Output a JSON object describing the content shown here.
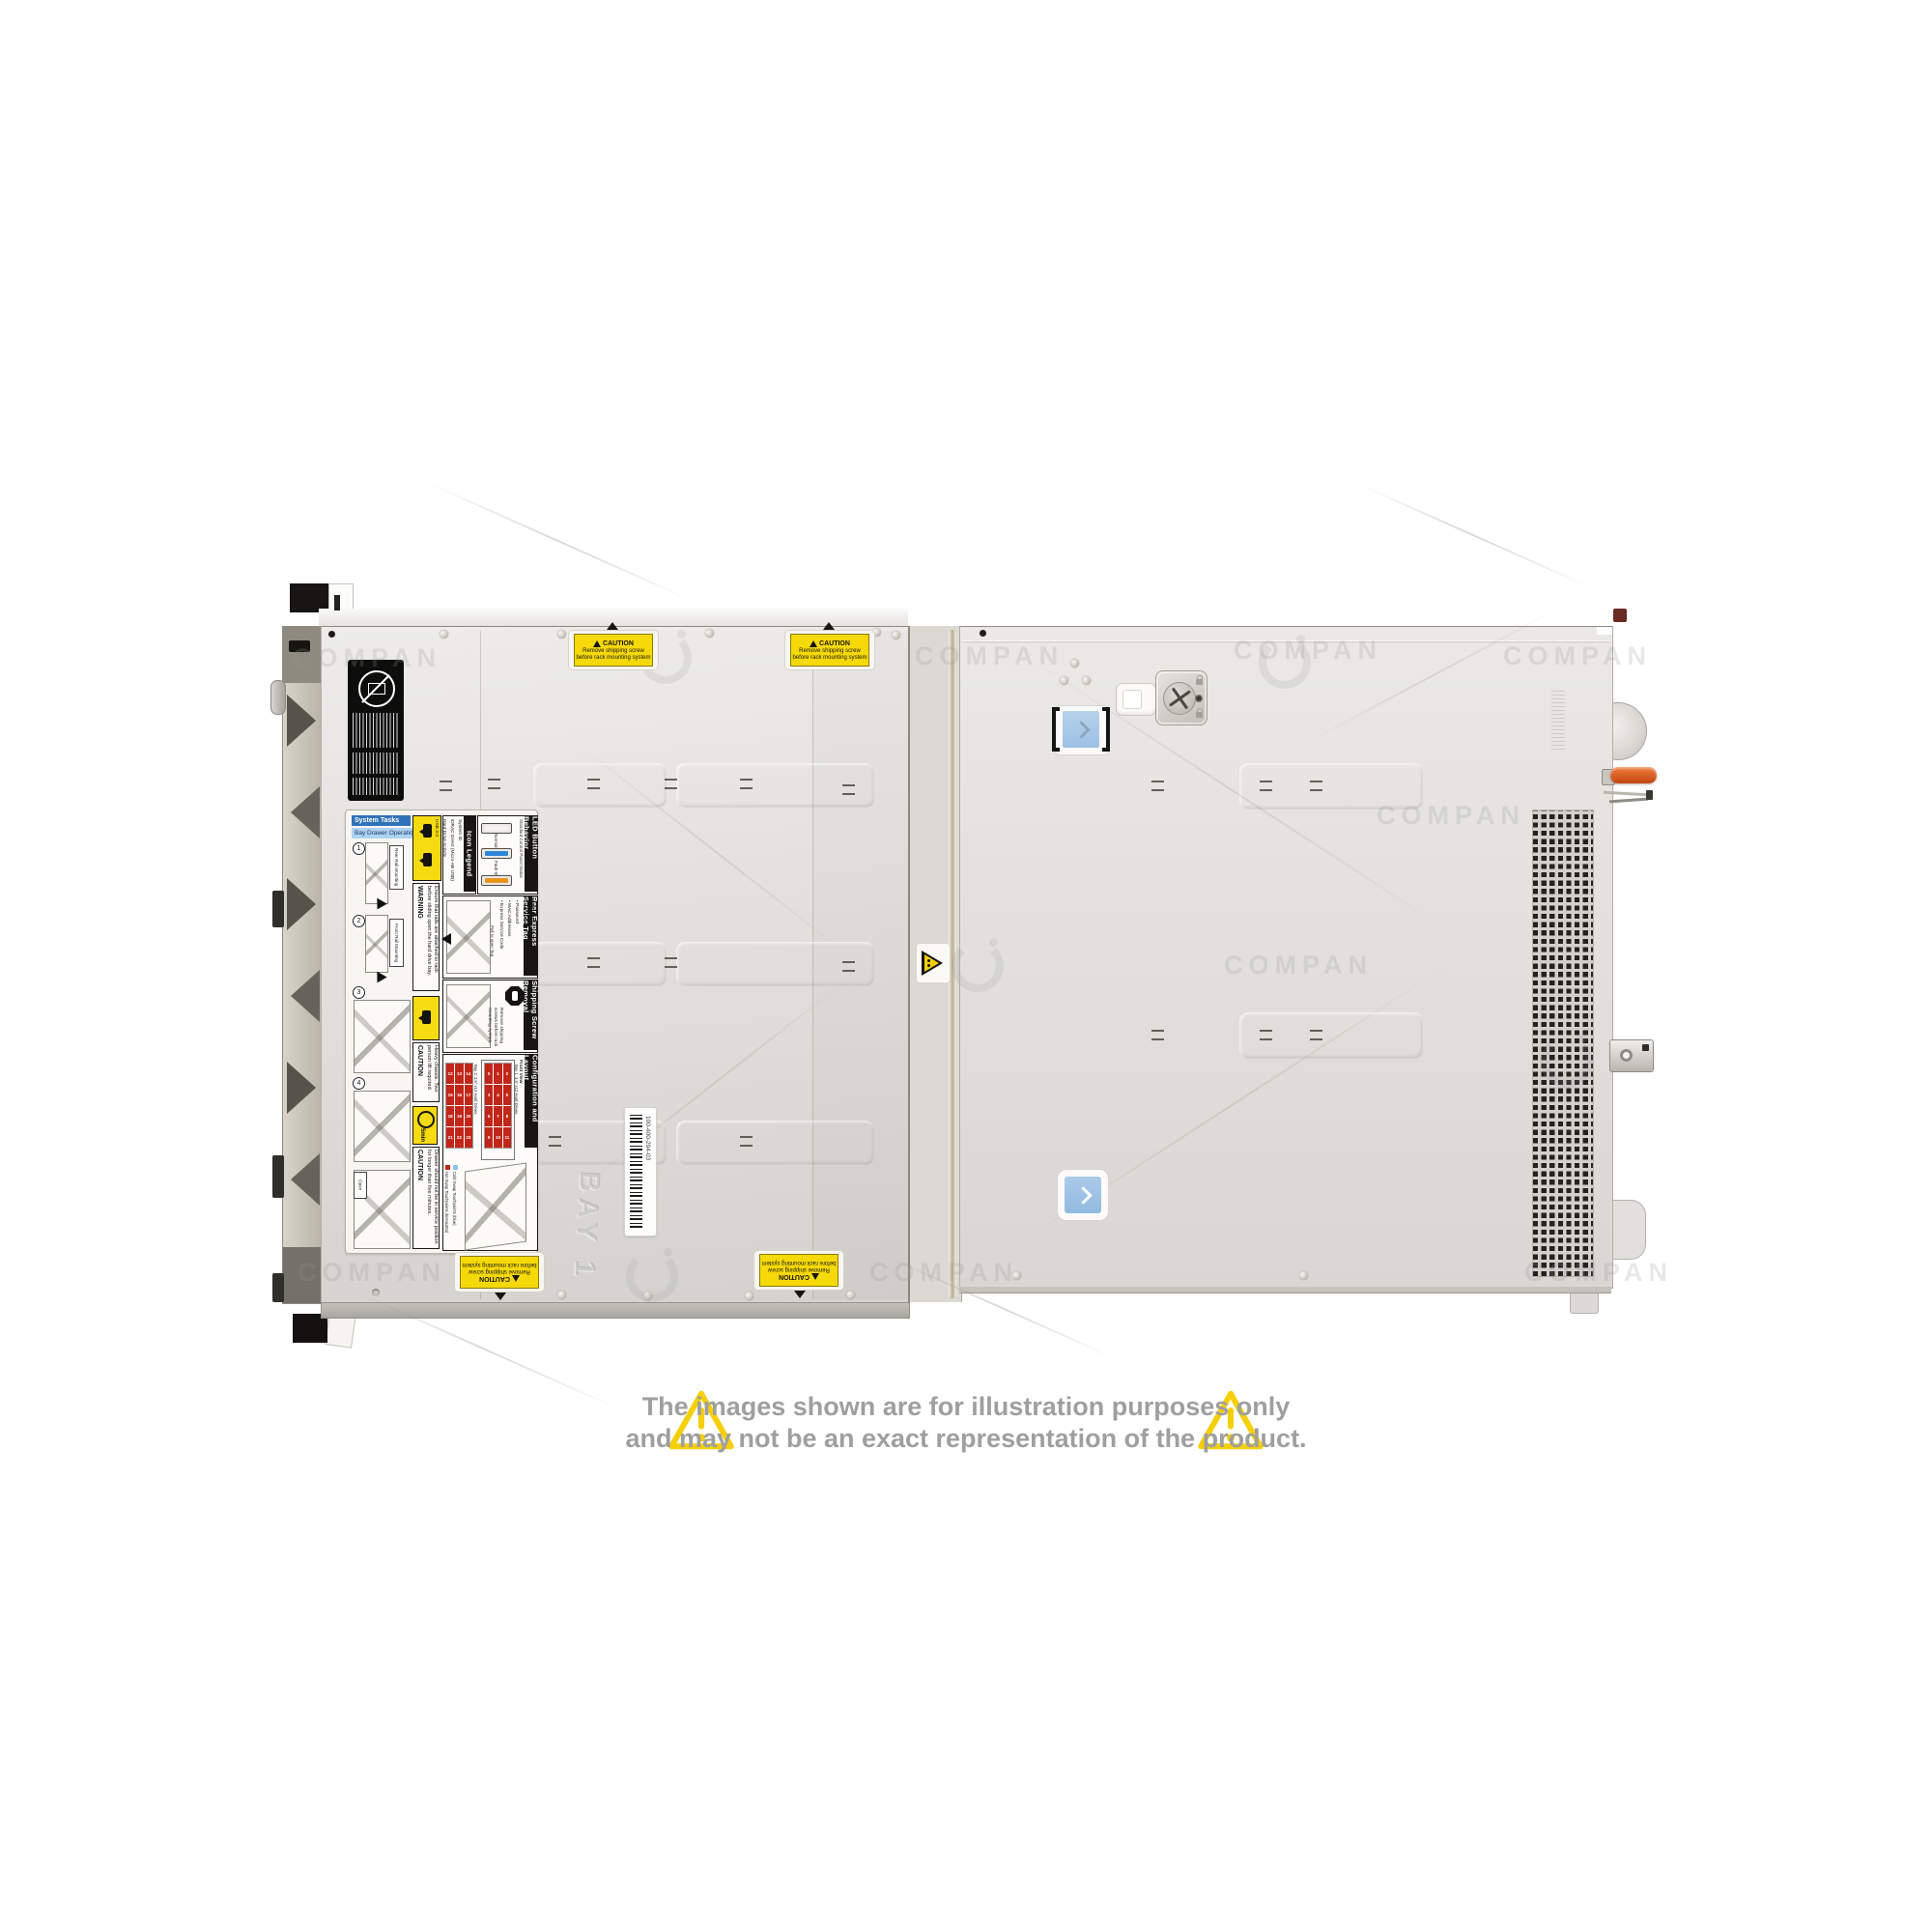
{
  "watermark": {
    "text": "COMPAN"
  },
  "disclaimer": {
    "line1": "The images shown are for illustration purposes only",
    "line2": "and may not be an exact representation of the product."
  },
  "caution_sticker": {
    "title": "CAUTION",
    "line1": "Remove shipping screw",
    "line2": "before rack mounting system"
  },
  "service_label": {
    "system_tasks": {
      "title": "System Tasks",
      "subtitle": "Bay Drawer Operation",
      "step_numbers": [
        "1",
        "2",
        "3",
        "4"
      ],
      "step1": "Rear Rail Mounting",
      "step2": "Front Rail Mounting",
      "step3": "Open"
    },
    "warning_rails": {
      "title": "WARNING",
      "text": "Ensure that rails are attached to rack before sliding open the hard drive bay."
    },
    "icon_legend": {
      "title": "Icon Legend",
      "items": [
        "System ID",
        "iDRAC Direct (Micro-AB USB)",
        "Hard Drive Activity",
        "USB 3.0"
      ]
    },
    "led_button": {
      "title": "LED Button Behavior",
      "subtitle": "Standard Control Panel Status",
      "state_normal": "Normal State",
      "state_fault": "Fault State"
    },
    "rear_express": {
      "title": "Rear Express Service Tag",
      "features_title": "Features:",
      "features": [
        "• Service Tag",
        "• Password",
        "• MAC Addresses",
        "• Express Service Code"
      ],
      "note": "Pull to open Tag"
    },
    "shipping": {
      "title": "Shipping Screw Removal",
      "text": "Remove shipping screws before rack mounting system."
    },
    "caution_heavy": {
      "title": "CAUTION",
      "text": "Heavy chassis. Two person lift required."
    },
    "timer": {
      "label": "5min"
    },
    "caution_drawer": {
      "title": "CAUTION",
      "text": "Drawer should not be in service position for longer than five minutes."
    },
    "config": {
      "title": "Configuration and Layout",
      "front_view": "Front View",
      "bay1_caption": "Bay 1: 3.5\" x12 Hard Drives",
      "bay2_caption": "Bay 2: 3.5\" x12 Hard Drives",
      "legend_hot": "Hot Swap Touchpoints (terracotta)",
      "legend_cold": "Cold Swap Touchpoints (blue)",
      "bay1_numbers": [
        "0",
        "1",
        "2",
        "3",
        "4",
        "5",
        "6",
        "7",
        "8",
        "9",
        "10",
        "11"
      ],
      "bay2_numbers": [
        "12",
        "13",
        "14",
        "15",
        "16",
        "17",
        "18",
        "19",
        "20",
        "21",
        "22",
        "23"
      ]
    }
  },
  "stickers": {
    "barcode_text": "100-400-294-03"
  },
  "embossed": {
    "bay_label": "BAY 1"
  },
  "colors": {
    "caution_yellow": "#f6d908",
    "touchpoint_blue": "#a9c9e8",
    "hot_swap_red": "#c22619",
    "lever_orange": "#d4572a"
  }
}
